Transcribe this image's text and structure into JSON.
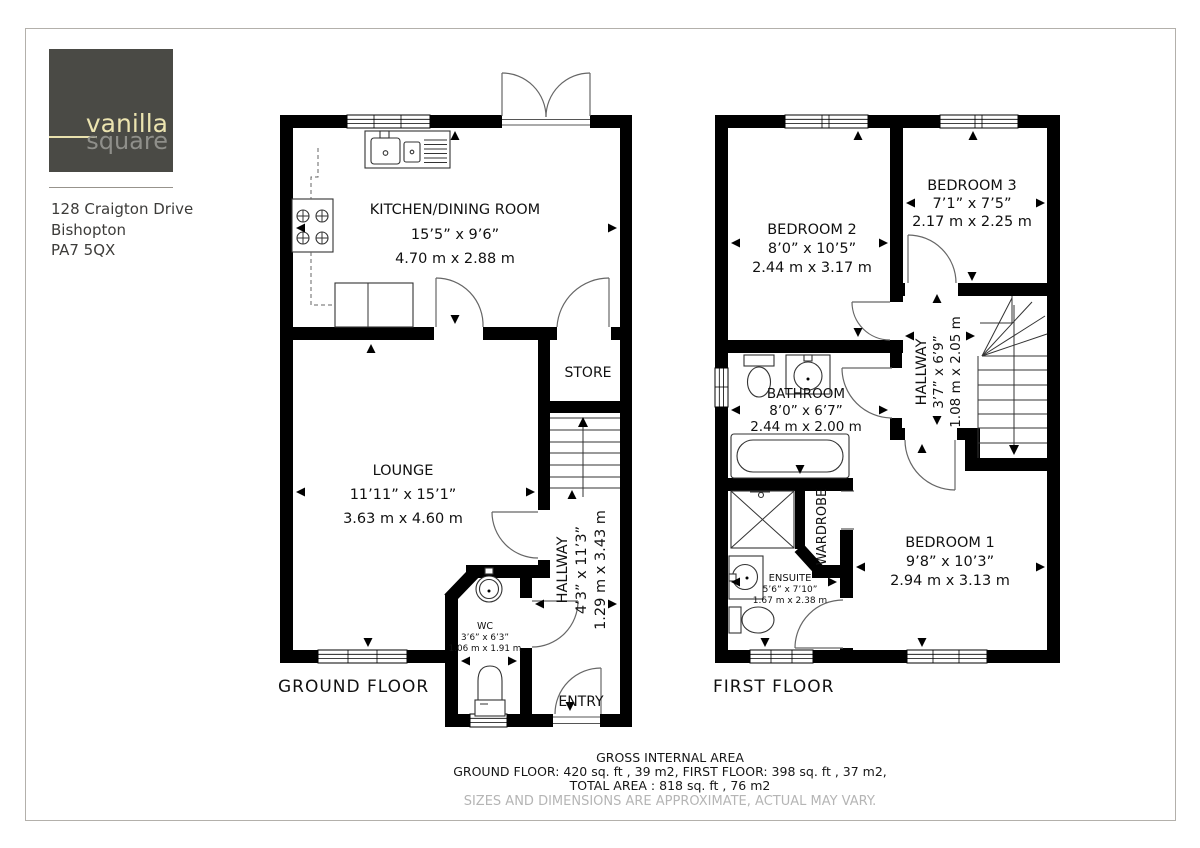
{
  "branding": {
    "logo_text_primary": "vanilla",
    "logo_text_secondary": "square",
    "logo_bg": "#4a4a45",
    "logo_primary_color": "#ece4b0",
    "logo_secondary_color": "#8f8f8a"
  },
  "address": {
    "line1": "128 Craigton Drive",
    "line2": "Bishopton",
    "line3": "PA7 5QX"
  },
  "ground_floor": {
    "floor_label": "GROUND FLOOR",
    "kitchen": {
      "name": "KITCHEN/DINING ROOM",
      "imperial": "15’5” x 9’6”",
      "metric": "4.70 m x 2.88 m"
    },
    "lounge": {
      "name": "LOUNGE",
      "imperial": "11’11” x 15’1”",
      "metric": "3.63 m x 4.60 m"
    },
    "store": {
      "name": "STORE"
    },
    "hallway": {
      "name": "HALLWAY",
      "imperial": "4’3” x 11’3”",
      "metric": "1.29 m x 3.43 m"
    },
    "wc": {
      "name": "WC",
      "imperial": "3’6” x 6’3”",
      "metric": "1.06 m x 1.91 m"
    },
    "entry": {
      "name": "ENTRY"
    }
  },
  "first_floor": {
    "floor_label": "FIRST FLOOR",
    "bedroom2": {
      "name": "BEDROOM 2",
      "imperial": "8’0” x 10’5”",
      "metric": "2.44 m x 3.17 m"
    },
    "bedroom3": {
      "name": "BEDROOM 3",
      "imperial": "7’1” x 7’5”",
      "metric": "2.17 m x 2.25 m"
    },
    "bathroom": {
      "name": "BATHROOM",
      "imperial": "8’0” x 6’7”",
      "metric": "2.44 m x 2.00 m"
    },
    "hallway": {
      "name": "HALLWAY",
      "imperial": "3’7” x 6’9”",
      "metric": "1.08 m x 2.05 m"
    },
    "bedroom1": {
      "name": "BEDROOM 1",
      "imperial": "9’8” x 10’3”",
      "metric": "2.94 m x 3.13 m"
    },
    "ensuite": {
      "name": "ENSUITE",
      "imperial": "5’6” x 7’10”",
      "metric": "1.67 m x 2.38 m"
    },
    "wardrobe": {
      "name": "WARDROBE"
    }
  },
  "footer": {
    "title": "GROSS INTERNAL AREA",
    "areas_line": "GROUND FLOOR: 420 sq. ft , 39 m2, FIRST FLOOR: 398 sq. ft , 37 m2,",
    "total_line": "TOTAL AREA : 818 sq. ft , 76 m2",
    "disclaimer": "SIZES AND DIMENSIONS ARE APPROXIMATE, ACTUAL MAY VARY."
  }
}
